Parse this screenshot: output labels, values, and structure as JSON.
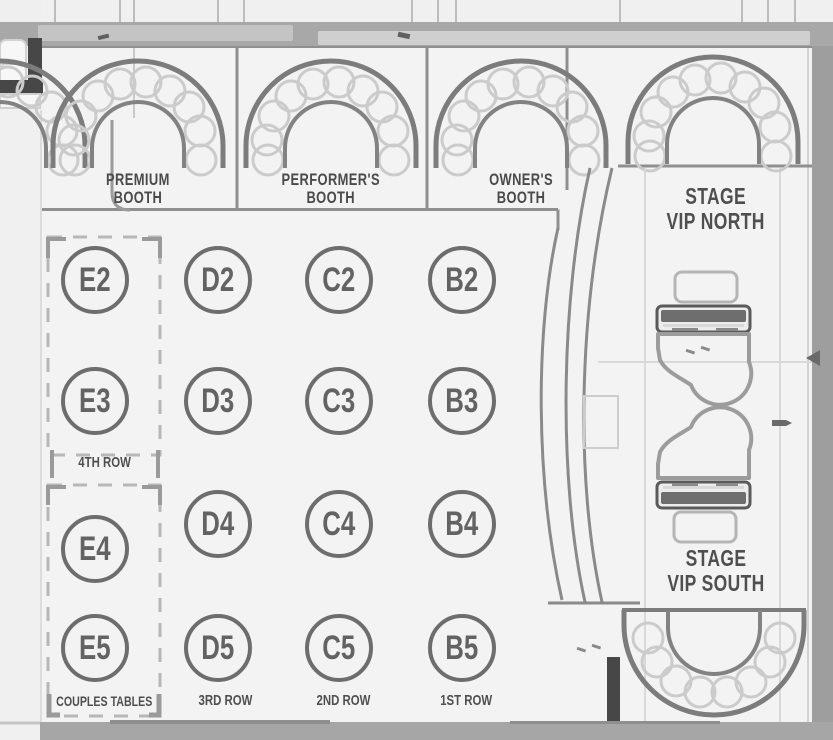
{
  "booths": [
    {
      "id": "premium-booth",
      "line1": "PREMIUM",
      "line2": "BOOTH"
    },
    {
      "id": "performers-booth",
      "line1": "PERFORMER'S",
      "line2": "BOOTH"
    },
    {
      "id": "owners-booth",
      "line1": "OWNER'S",
      "line2": "BOOTH"
    }
  ],
  "vip_north": {
    "line1": "STAGE",
    "line2": "VIP NORTH"
  },
  "vip_south": {
    "line1": "STAGE",
    "line2": "VIP SOUTH"
  },
  "tables": [
    "E2",
    "D2",
    "C2",
    "B2",
    "E3",
    "D3",
    "C3",
    "B3",
    "E4",
    "D4",
    "C4",
    "B4",
    "E5",
    "D5",
    "C5",
    "B5"
  ],
  "row_labels": {
    "row4": "4TH ROW",
    "couples": "COUPLES TABLES",
    "row3": "3RD ROW",
    "row2": "2ND ROW",
    "row1": "1ST ROW"
  },
  "colors": {
    "wall": "#7c7c7c",
    "wall_dark": "#474747",
    "seat_ring": "#cbcbcb",
    "band_gray": "#a8a8a8",
    "label_text": "#4a4a4a",
    "table_ring": "#6d6d6d",
    "floor": "#f3f3f3",
    "dashed_box": "#b7b7b7"
  }
}
